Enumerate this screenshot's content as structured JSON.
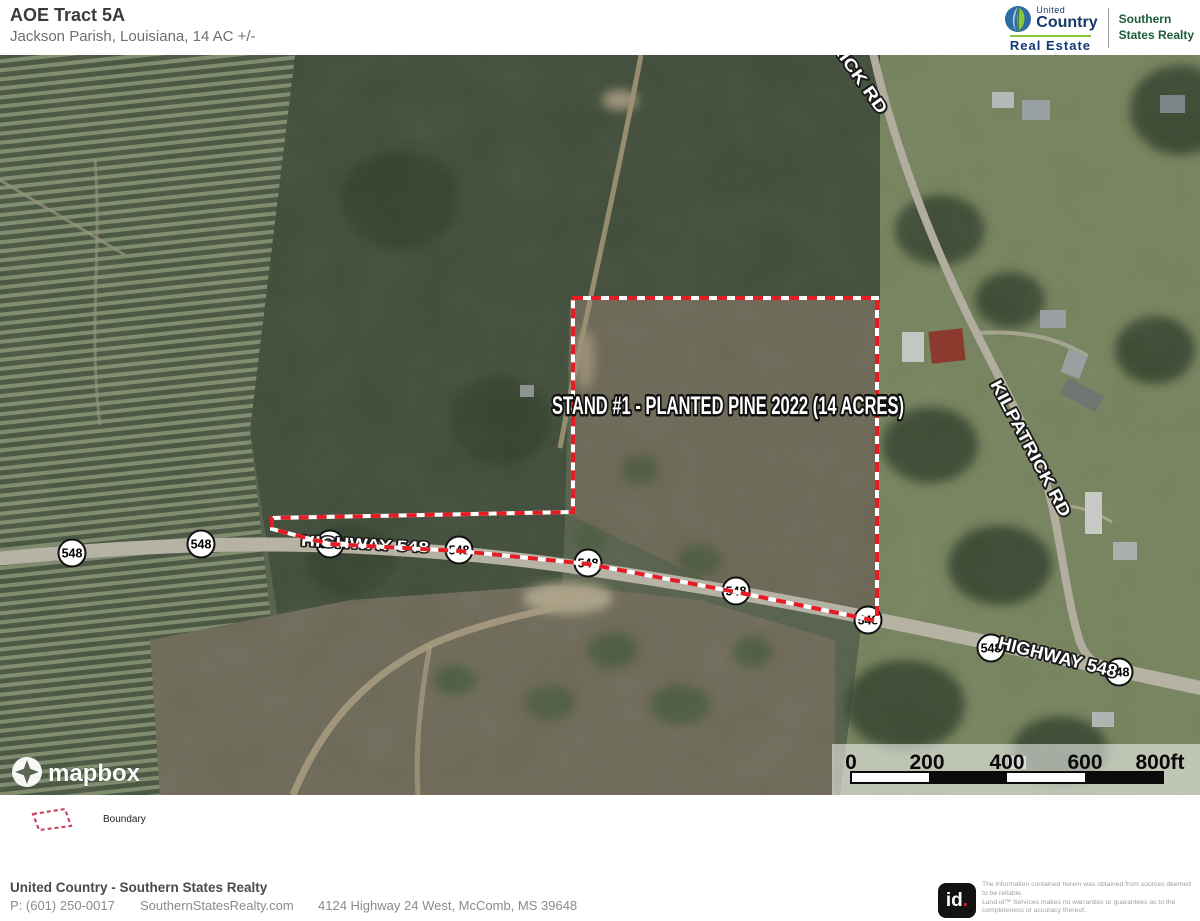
{
  "header": {
    "title": "AOE Tract 5A",
    "subtitle": "Jackson Parish, Louisiana, 14 AC +/-",
    "brand": {
      "united": "United",
      "country": "Country",
      "real_estate": "Real Estate",
      "southern_1": "Southern",
      "southern_2": "States Realty"
    }
  },
  "map": {
    "stand_label": "STAND #1 - PLANTED PINE 2022 (14 ACRES)",
    "highway_label": "HIGHWAY 548",
    "kilpatrick_label": "KILPATRICK RD",
    "shield_label": "548",
    "attribution": "mapbox",
    "scale_ticks": [
      "0",
      "200",
      "400",
      "600",
      "800ft"
    ]
  },
  "legend": {
    "boundary_label": "Boundary"
  },
  "footer": {
    "company": "United Country - Southern States Realty",
    "phone": "P: (601) 250-0017",
    "website": "SouthernStatesRealty.com",
    "address": "4124 Highway 24 West, McComb, MS 39648",
    "id_logo": "id",
    "id_dot": ".",
    "disclaimer_1": "The information contained herein was obtained from sources deemed to be reliable.",
    "disclaimer_2": "Land id™ Services makes no warranties or guarantees as to the completeness or accuracy thereof."
  },
  "colors": {
    "boundary": "#e51c23",
    "brand_navy": "#16386b",
    "brand_green": "#1e5b3c"
  }
}
